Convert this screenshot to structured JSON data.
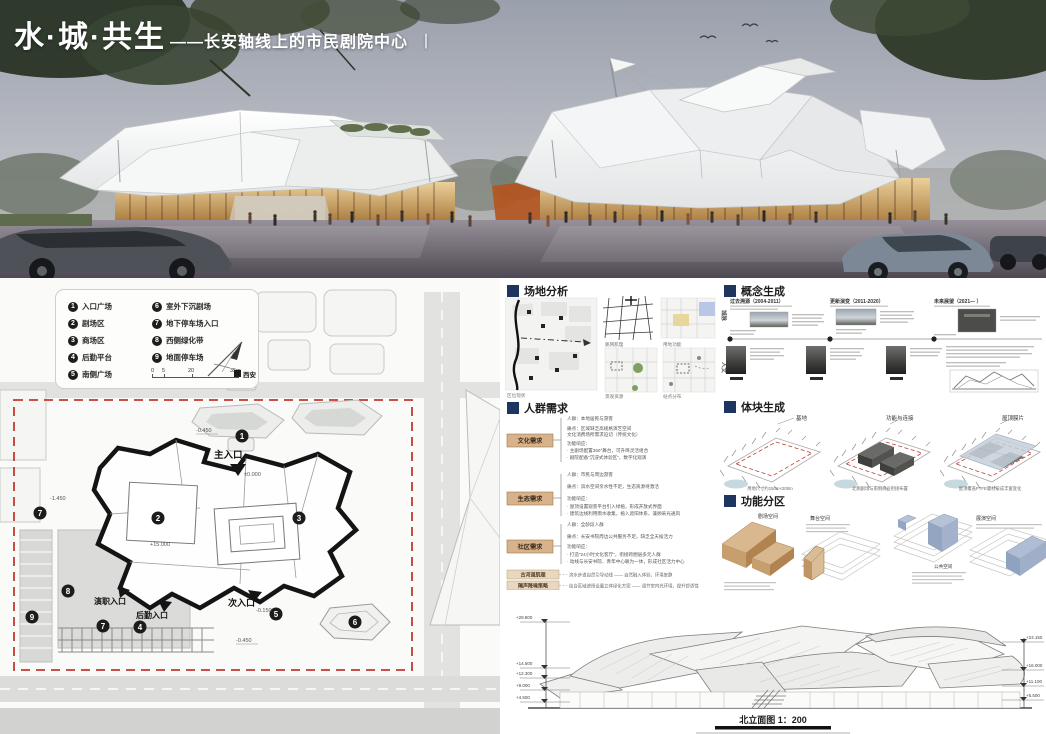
{
  "title": {
    "main": "水·城·共生",
    "dash_sub": "——长安轴线上的市民剧院中心",
    "bar": "丨"
  },
  "sections": {
    "site_plan": "总平面图",
    "site_analysis": "场地分析",
    "concept": "概念生成",
    "crowd": "人群需求",
    "massing": "体块生成",
    "zoning": "功能分区"
  },
  "site_plan": {
    "legend": [
      {
        "num": "1",
        "label": "入口广场"
      },
      {
        "num": "2",
        "label": "剧场区"
      },
      {
        "num": "3",
        "label": "商场区"
      },
      {
        "num": "4",
        "label": "后勤平台"
      },
      {
        "num": "5",
        "label": "南侧广场"
      },
      {
        "num": "6",
        "label": "室外下沉剧场"
      },
      {
        "num": "7",
        "label": "地下停车场入口"
      },
      {
        "num": "8",
        "label": "西侧绿化带"
      },
      {
        "num": "9",
        "label": "地面停车场"
      }
    ],
    "scale_ticks": [
      "0",
      "5",
      "20",
      "35m"
    ],
    "compass_label": "西安",
    "entrances": {
      "main": "主入口",
      "secondary": "次入口",
      "logistics": "后勤入口",
      "performer": "演职入口"
    },
    "levels": {
      "a": "-0.450",
      "b": "±0.000",
      "c": "+15.000",
      "d": "-0.450",
      "e": "-0.150",
      "f": "-1.450"
    }
  },
  "site_analysis": {
    "captions": [
      "区位现状",
      "路网肌理",
      "用地功能",
      "景观资源",
      "站点分布"
    ]
  },
  "concept": {
    "axis_labels": [
      "城脉",
      "人文"
    ],
    "periods": [
      {
        "title": "过去溯源（2004-2011）"
      },
      {
        "title": "更新演变（2011-2020）"
      },
      {
        "title": "未来展望（2021—  ）"
      }
    ]
  },
  "crowd": {
    "groups": [
      {
        "label": "文化需求",
        "lines": [
          "人群：本地居民与游客",
          "痛点：区域缺乏高规格演艺空间",
          "文化消费场所需求迫切（传统文化）",
          "功能响应：",
          "· 主剧场配置360°舞台，可升降灵活组合",
          "· 剧院配备“沉浸式体验区”，数字化观演"
        ]
      },
      {
        "label": "生态需求",
        "lines": [
          "人群：市民与周边游客",
          "痛点：滨水空间亲水性不足，生态资源待激活",
          "功能响应：",
          "· 屋顶设置观景平台引入绿植，形成开放式界面",
          "· 建筑边线利用雨水收集，植入遮阳体系，兼顾采光通风"
        ]
      },
      {
        "label": "社区需求",
        "lines": [
          "人群：全龄段人群",
          "痛点：长安书院周边公共服务不足，缺乏全天候活力",
          "功能响应：",
          "· 打造“24小时文化客厅”，衔接跨圈层多元人群",
          "· 动线与长安书院、青年中心联为一体，形成社区活力中心"
        ]
      }
    ],
    "extras": [
      {
        "label": "古河道肌理",
        "text": "滨水步道自然引导动线 —— 自然融入体验，环境安静"
      },
      {
        "label": "隔声降噪策略",
        "text": "结合区域遮阳设置立体绿化方案 —— 调节室内光环境，提升舒适性"
      }
    ]
  },
  "massing": {
    "steps": [
      {
        "label": "基地",
        "caption": "用地尺寸约150m×200m"
      },
      {
        "label": "功能与连接",
        "caption": "北侧剧场与南侧商业衔接布置"
      },
      {
        "label": "屋顶膜片",
        "caption": "屋顶覆盖PTFE膜材形成丰富变化"
      }
    ]
  },
  "zoning": {
    "blocks": [
      {
        "label": "剧场空间"
      },
      {
        "label": "舞台空间"
      },
      {
        "label": "公共空间"
      },
      {
        "label": "展演空间"
      }
    ]
  },
  "elevation": {
    "caption": "北立面图 1：200",
    "left_levels": [
      "+28.800",
      "+14.500",
      "+12.300",
      "+9.000",
      "+4.500"
    ],
    "right_levels": [
      "+23.150",
      "+16.000",
      "+11.100",
      "+5.500"
    ]
  }
}
